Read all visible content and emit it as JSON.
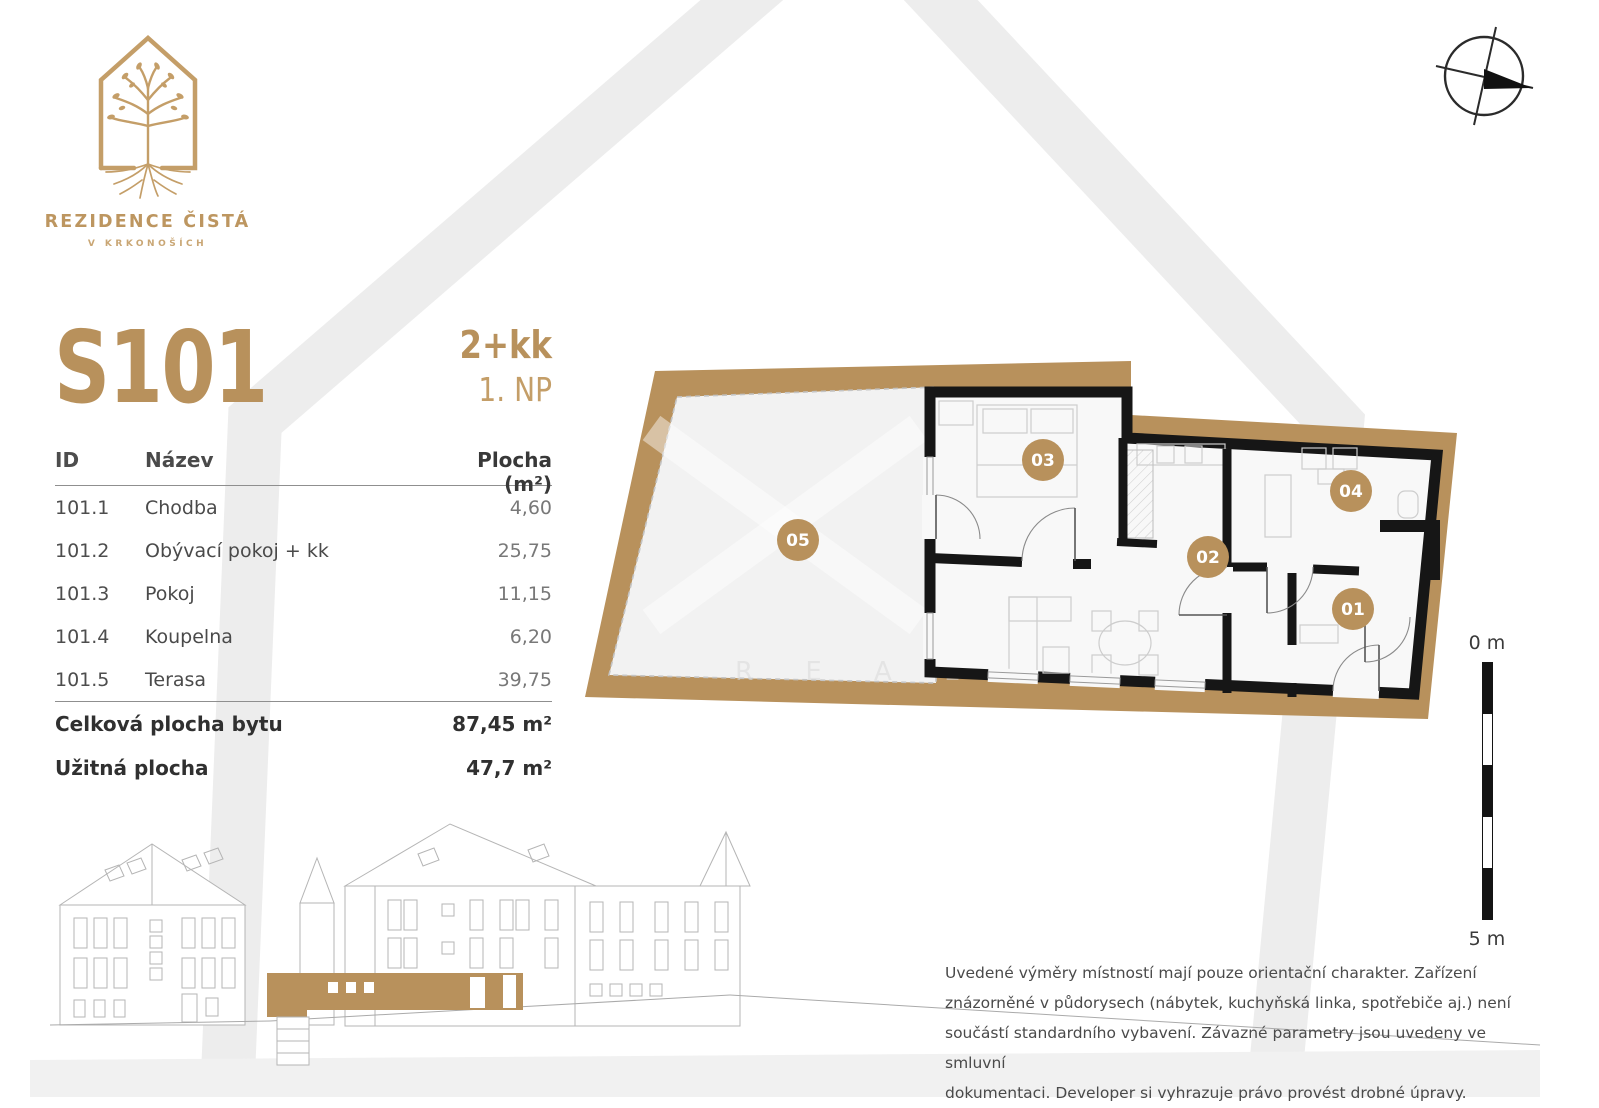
{
  "brand": {
    "name": "REZIDENCE ČISTÁ",
    "tagline": "V KRKONOŠÍCH"
  },
  "unit": {
    "code": "S101",
    "disposition": "2+kk",
    "floor": "1. NP"
  },
  "area_table": {
    "col_id": "ID",
    "col_name": "Název",
    "col_area": "Plocha (m²)",
    "rows": [
      {
        "id": "101.1",
        "name": "Chodba",
        "area": "4,60"
      },
      {
        "id": "101.2",
        "name": "Obývací pokoj + kk",
        "area": "25,75"
      },
      {
        "id": "101.3",
        "name": "Pokoj",
        "area": "11,15"
      },
      {
        "id": "101.4",
        "name": "Koupelna",
        "area": "6,20"
      },
      {
        "id": "101.5",
        "name": "Terasa",
        "area": "39,75"
      }
    ],
    "total_label": "Celková plocha bytu",
    "total_value": "87,45 m²",
    "usable_label": "Užitná plocha",
    "usable_value": "47,7 m²"
  },
  "plan": {
    "rooms": [
      {
        "label": "01"
      },
      {
        "label": "02"
      },
      {
        "label": "03"
      },
      {
        "label": "04"
      },
      {
        "label": "05"
      }
    ],
    "scale_top": "0 m",
    "scale_bottom": "5 m",
    "watermark": "R E A L"
  },
  "disclaimer": {
    "lines": [
      "Uvedené výměry místností mají pouze orientační charakter. Zařízení",
      "znázorněné v půdorysech (nábytek, kuchyňská linka, spotřebiče aj.) není",
      "součástí standardního vybavení. Závazné parametry jsou uvedeny ve smluvní",
      "dokumentaci. Developer si vyhrazuje právo provést drobné úpravy."
    ]
  },
  "colors": {
    "gold": "#b8915c",
    "logo_gold": "#bd9660",
    "wall_black": "#161616",
    "background_house_gray": "#ededed",
    "floor_gray": "#f2f2f2"
  }
}
